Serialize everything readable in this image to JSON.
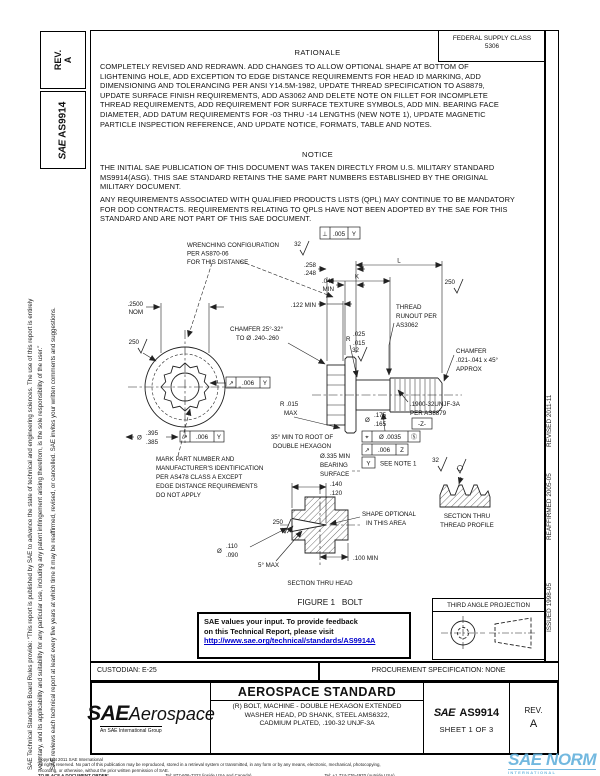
{
  "header": {
    "fsc_label": "FEDERAL SUPPLY CLASS",
    "fsc_code": "5306",
    "rationale_title": "RATIONALE",
    "rationale_body": "COMPLETELY REVISED AND REDRAWN. ADD CHANGES TO ALLOW OPTIONAL SHAPE AT BOTTOM OF LIGHTENING HOLE, ADD EXCEPTION TO EDGE DISTANCE REQUIREMENTS FOR HEAD ID MARKING, ADD DIMENSIONING AND TOLERANCING PER ANSI Y14.5M-1982, UPDATE THREAD SPECIFICATION TO AS8879, UPDATE SURFACE FINISH REQUIREMENTS, ADD AS3062 AND DELETE NOTE ON FILLET FOR INCOMPLETE THREAD REQUIREMENTS, ADD REQUIREMENT FOR SURFACE TEXTURE SYMBOLS, ADD MIN. BEARING FACE DIAMETER, ADD DATUM REQUIREMENTS FOR -03 THRU -14 LENGTHS (NEW NOTE 1), UPDATE MAGNETIC PARTICLE INSPECTION REFERENCE, AND UPDATE NOTICE, FORMATS, TABLE AND NOTES.",
    "notice_title": "NOTICE",
    "notice_p1": "THE INITIAL SAE PUBLICATION OF THIS DOCUMENT WAS TAKEN DIRECTLY FROM U.S. MILITARY STANDARD MS9914(ASG). THIS SAE STANDARD RETAINS THE SAME PART NUMBERS ESTABLISHED BY THE ORIGINAL MILITARY DOCUMENT.",
    "notice_p2": "ANY REQUIREMENTS ASSOCIATED WITH QUALIFIED PRODUCTS LISTS (QPL) MAY CONTINUE TO BE MANDATORY FOR DOD CONTRACTS. REQUIREMENTS RELATING TO QPLS HAVE NOT BEEN ADOPTED BY THE SAE FOR THIS STANDARD AND ARE NOT PART OF THIS SAE DOCUMENT."
  },
  "sidebar_left": {
    "rev_label": "REV.",
    "rev_value": "A",
    "doc_logo": "SAE",
    "doc_number": "AS9914",
    "disclaimer_line1": "SAE Technical Standards Board Rules provide: “This report is published by SAE to advance the state of technical and engineering sciences. The use of this report is entirely",
    "disclaimer_line2": "voluntary, and its applicability and suitability for any particular use, including any patent infringement arising therefrom, is the sole responsibility of the user.”",
    "disclaimer_line3": "SAE reviews each technical report at least every five years at which time it may be reaffirmed, revised, or cancelled. SAE invites your written comments and suggestions."
  },
  "sidebar_right": {
    "revised": "REVISED 2011-11",
    "reaffirmed": "REAFFIRMED 2005-05",
    "issued": "ISSUED 1998-05"
  },
  "drawing": {
    "wrench_note": [
      "WRENCHING CONFIGURATION",
      "PER AS870-06",
      "FOR THIS DISTANCE"
    ],
    "fcf_perp": {
      "sym": "⊥",
      "tol": ".005",
      "datum": "Y"
    },
    "surf_32": "32",
    "surf_250": "250",
    "dim_head_height": [
      ".258",
      ".248"
    ],
    "dim_washer": [
      ".040",
      "MIN"
    ],
    "dim_L": "L",
    "dim_K": "K",
    "dim_wrench_depth": ".122 MIN",
    "dim_af": [
      ".2500",
      "NOM"
    ],
    "chamfer_head": [
      "CHAMFER 25°-32°",
      "TO Ø .240-.260"
    ],
    "runout_note": [
      "THREAD",
      "RUNOUT PER",
      "AS3062"
    ],
    "fillet": {
      "r": "R",
      "hi": ".025",
      "lo": ".015"
    },
    "chamfer_thread": [
      "CHAMFER",
      ".021-.041 x 45°",
      "APPROX"
    ],
    "thread_callout": [
      ".1900-32UNJF-3A",
      "PER AS8879"
    ],
    "datum_z": "-Z-",
    "dim_shank": {
      "sym": "Ø",
      "hi": ".175",
      "lo": ".165"
    },
    "fcf_pos": {
      "sym": "⌖",
      "tol": "Ø .0035",
      "mod": "Ⓢ"
    },
    "fcf_runout_z": {
      "sym": "↗",
      "tol": ".006",
      "datum": "Z"
    },
    "datum_y": "Y",
    "see_note": "SEE NOTE 1",
    "hex_angle": [
      "35° MIN TO ROOT OF",
      "DOUBLE HEXAGON"
    ],
    "bearing": [
      "Ø.335 MIN",
      "BEARING",
      "SURFACE"
    ],
    "mark_note": [
      "MARK PART NUMBER AND",
      "MANUFACTURER'S IDENTIFICATION",
      "PER AS478 CLASS A EXCEPT",
      "EDGE DISTANCE REQUIREMENTS",
      "DO NOT APPLY"
    ],
    "dim_head_od": {
      "sym": "Ø",
      "hi": ".395",
      "lo": ".385"
    },
    "fcf_runout_y": {
      "sym": "↗",
      "tol": ".006",
      "datum": "Y"
    },
    "radius_max": [
      "R .015",
      "MAX"
    ],
    "dim_hole_depth": [
      ".140",
      ".120"
    ],
    "shape_note": [
      "SHAPE OPTIONAL",
      "IN THIS AREA"
    ],
    "dim_hole": {
      "sym": "Ø",
      "hi": ".110",
      "lo": ".090"
    },
    "taper": "5° MAX",
    "dim_100": ".100 MIN",
    "section_head": "SECTION THRU HEAD",
    "section_thread": [
      "SECTION THRU",
      "THREAD PROFILE"
    ],
    "figure_caption": "FIGURE 1   BOLT"
  },
  "feedback": {
    "line1": "SAE values your input. To provide feedback",
    "line2": "on this Technical Report, please visit",
    "link": "http://www.sae.org/technical/standards/AS9914A"
  },
  "projection": {
    "label": "THIRD ANGLE PROJECTION"
  },
  "admin": {
    "custodian": "CUSTODIAN: E-25",
    "procurement": "PROCUREMENT SPECIFICATION: NONE"
  },
  "title_block": {
    "logo_main": "SAE",
    "logo_aero": "Aerospace",
    "logo_sub": "An SAE International Group",
    "doc_type": "AEROSPACE STANDARD",
    "title_line1": "(R) BOLT, MACHINE - DOUBLE HEXAGON EXTENDED",
    "title_line2": "WASHER HEAD, PD SHANK, STEEL AMS6322,",
    "title_line3": "CADMIUM PLATED, .190-32 UNJF-3A",
    "num_logo": "SAE",
    "doc_number": "AS9914",
    "sheet": "SHEET 1 OF 3",
    "rev_label": "REV.",
    "rev_value": "A"
  },
  "footer": {
    "copyright1": "Copyright 2011 SAE International",
    "copyright2": "All rights reserved. No part of this publication may be reproduced, stored in a retrieval system or transmitted, in any form or by any means, electronic, mechanical, photocopying,",
    "copyright3": "recording, or otherwise, without the prior written permission of SAE.",
    "order_label": "TO PLACE A DOCUMENT ORDER:",
    "tel_inside": "Tel: 877-606-7323 (inside USA and Canada)",
    "fax": "Fax: 724-776-0790",
    "tel_outside": "Tel: +1 724-776-4970 (outside USA)",
    "email": "Email: CustomerService@sae.org",
    "web": "SAE WEB ADDRESS: http://www.sae.org"
  },
  "watermark": {
    "logo": "SAE",
    "brand": "NORM",
    "sub": "INTERNATIONAL"
  }
}
